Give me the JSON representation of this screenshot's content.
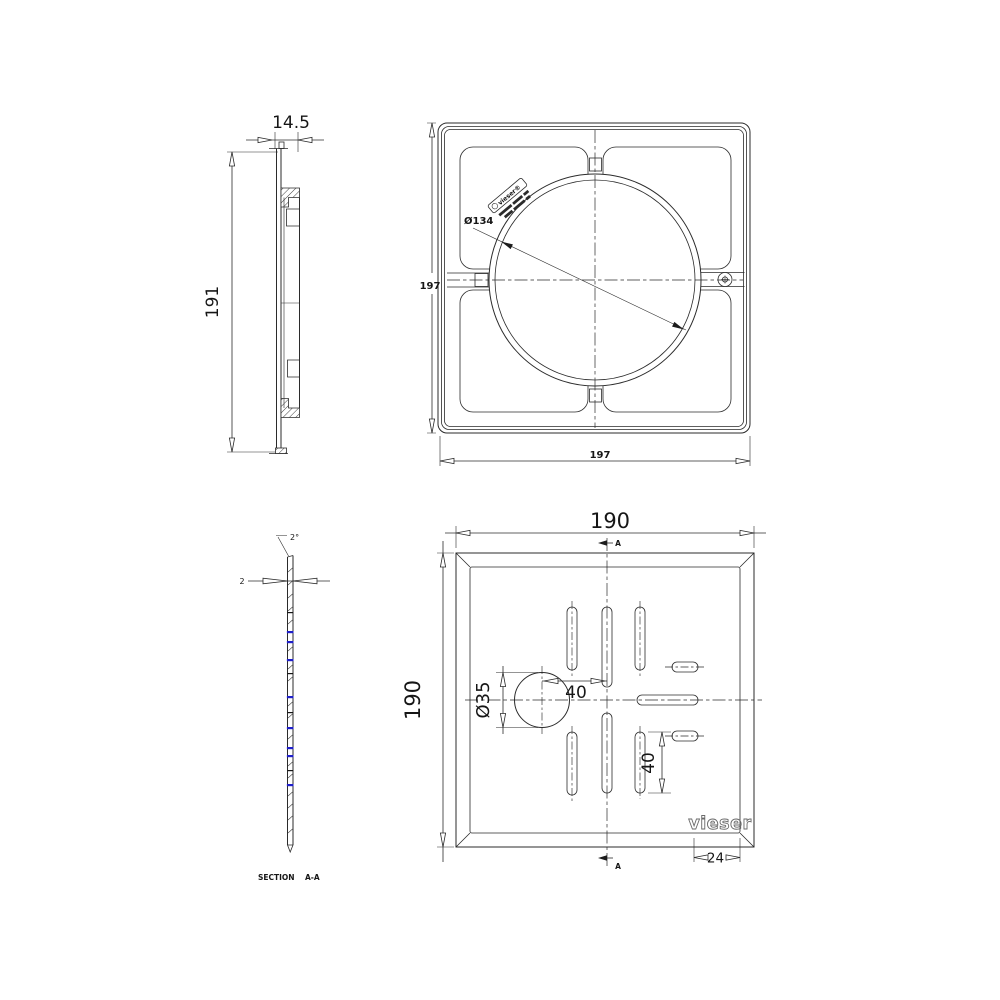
{
  "drawing": {
    "side_view": {
      "width": "14.5",
      "height": "191"
    },
    "back_view": {
      "width": "197",
      "height": "197",
      "circle_diameter": "Ø134",
      "stamp_brand": "vieser®"
    },
    "section_view": {
      "thickness": "2",
      "angle": "2°",
      "caption": "SECTION",
      "caption_ref": "A-A"
    },
    "top_view": {
      "width": "190",
      "height": "190",
      "hole_diameter": "Ø35",
      "hole_offset": "40",
      "slot_length": "40",
      "logo_width": "24",
      "marker": "A",
      "brand": "vieser"
    }
  },
  "colors": {
    "line": "#2b2b2b",
    "accent_blue": "#1f1fc8",
    "background": "#ffffff",
    "brand_outline": "#6a6a6a"
  }
}
